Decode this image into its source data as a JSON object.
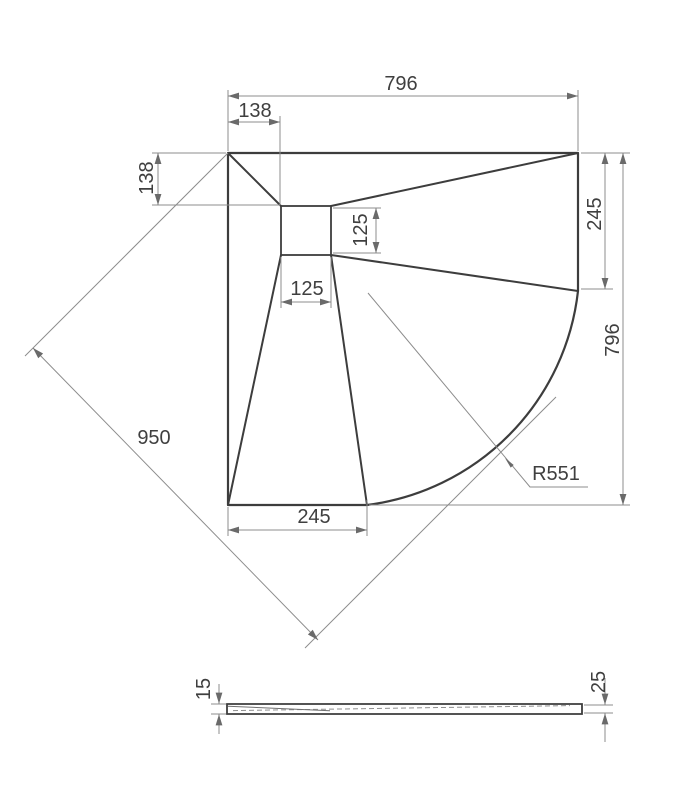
{
  "drawing": {
    "plan": {
      "width_top": "796",
      "offset_top": "138",
      "offset_left": "138",
      "drain_width": "125",
      "drain_depth": "125",
      "corner_edge_right": "245",
      "height_right": "796",
      "diagonal": "950",
      "radius": "R551",
      "corner_edge_bottom": "245"
    },
    "section": {
      "thickness_min": "15",
      "thickness_edge": "25"
    },
    "colors": {
      "outline": "#3d3d3d",
      "dimension_lines": "#8c8c8c",
      "text": "#3f3f3f",
      "background": "#ffffff"
    }
  }
}
